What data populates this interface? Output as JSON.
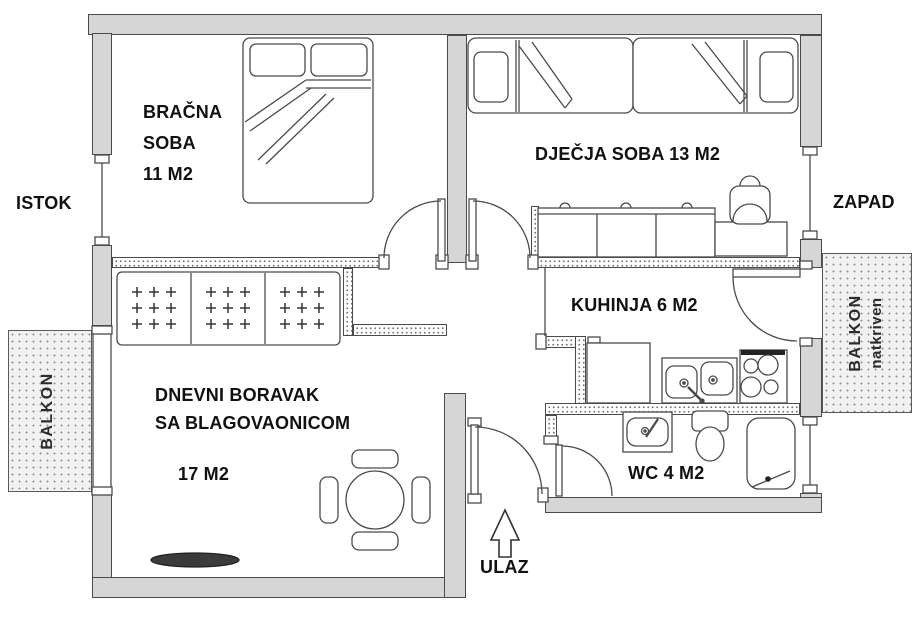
{
  "floorplan": {
    "compass": {
      "east_label": "ISTOK",
      "west_label": "ZAPAD"
    },
    "rooms": {
      "master_bedroom": {
        "line1": "BRAČNA",
        "line2": "SOBA",
        "area": "11 M2"
      },
      "kids_room": {
        "label": "DJEČJA SOBA 13 M2"
      },
      "kitchen": {
        "label": "KUHINJA 6 M2"
      },
      "living_room": {
        "line1": "DNEVNI BORAVAK",
        "line2": "SA BLAGOVAONICOM",
        "area": "17 M2"
      },
      "wc": {
        "label": "WC 4 M2"
      },
      "entrance": {
        "label": "ULAZ"
      },
      "balcony_east": {
        "label": "BALKON"
      },
      "balcony_west": {
        "line1": "BALKON",
        "line2": "natkriven"
      }
    },
    "colors": {
      "wall_fill": "#d6d6d6",
      "wall_outline": "#4a4a4a",
      "label_text": "#111111",
      "balcony_fill": "#f1f1f1",
      "furniture_outline": "#555555"
    }
  }
}
